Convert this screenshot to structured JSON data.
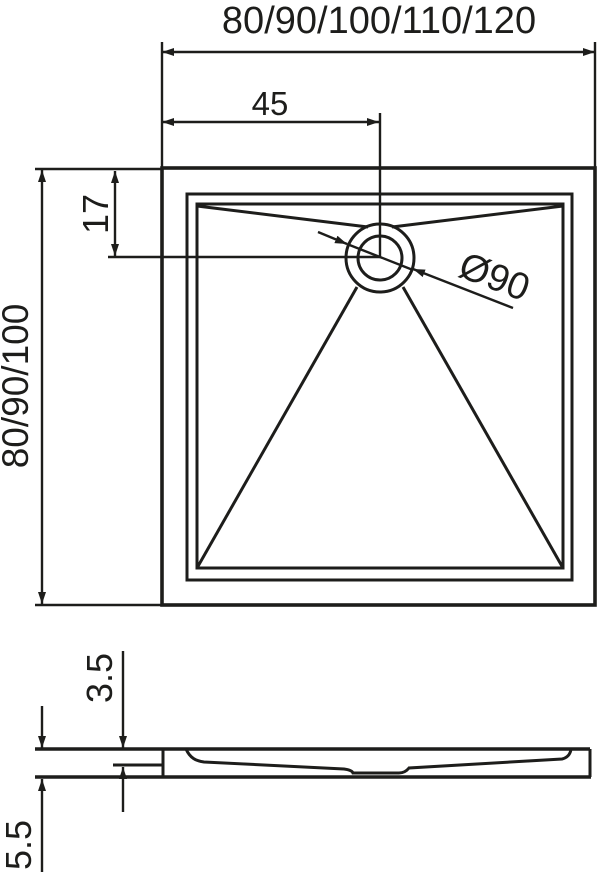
{
  "colors": {
    "ink": "#1d1d1b",
    "paper": "#ffffff"
  },
  "plan_view": {
    "width_label": "80/90/100/110/120",
    "depth_label": "80/90/100",
    "drain_offset_from_left_label": "45",
    "drain_offset_from_top_label": "17",
    "drain_diameter_label": "Ø90"
  },
  "side_view": {
    "floor_height_label": "3.5",
    "total_height_label": "5.5"
  }
}
